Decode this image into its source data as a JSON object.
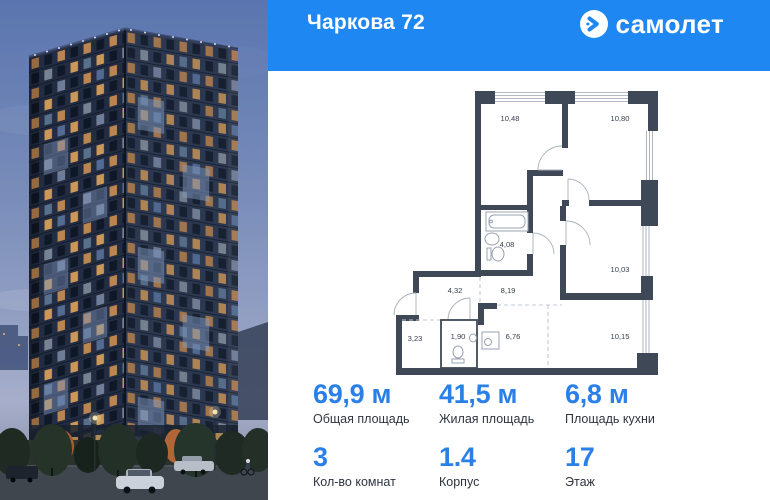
{
  "header": {
    "title": "Чаркова 72",
    "brand": "самолет"
  },
  "plan": {
    "rooms": [
      {
        "id": "room-top-left",
        "area": "10,48"
      },
      {
        "id": "room-top-right",
        "area": "10,80"
      },
      {
        "id": "bathroom",
        "area": "4,08"
      },
      {
        "id": "room-mid-right",
        "area": "10,03"
      },
      {
        "id": "hallway",
        "area": "4,32"
      },
      {
        "id": "corridor",
        "area": "8,19"
      },
      {
        "id": "storage",
        "area": "3,23"
      },
      {
        "id": "wc",
        "area": "1,90"
      },
      {
        "id": "kitchen",
        "area": "6,76"
      },
      {
        "id": "room-bottom-right",
        "area": "10,15"
      }
    ]
  },
  "stats": {
    "row1": [
      {
        "value": "69,9 м",
        "label": "Общая площадь"
      },
      {
        "value": "41,5 м",
        "label": "Жилая площадь"
      },
      {
        "value": "6,8 м",
        "label": "Площадь кухни"
      }
    ],
    "row2": [
      {
        "value": "3",
        "label": "Кол-во комнат"
      },
      {
        "value": "1.4",
        "label": "Корпус"
      },
      {
        "value": "17",
        "label": "Этаж"
      }
    ]
  },
  "colors": {
    "header_blue": "#1e87f2",
    "accent_blue": "#2b80e8"
  }
}
